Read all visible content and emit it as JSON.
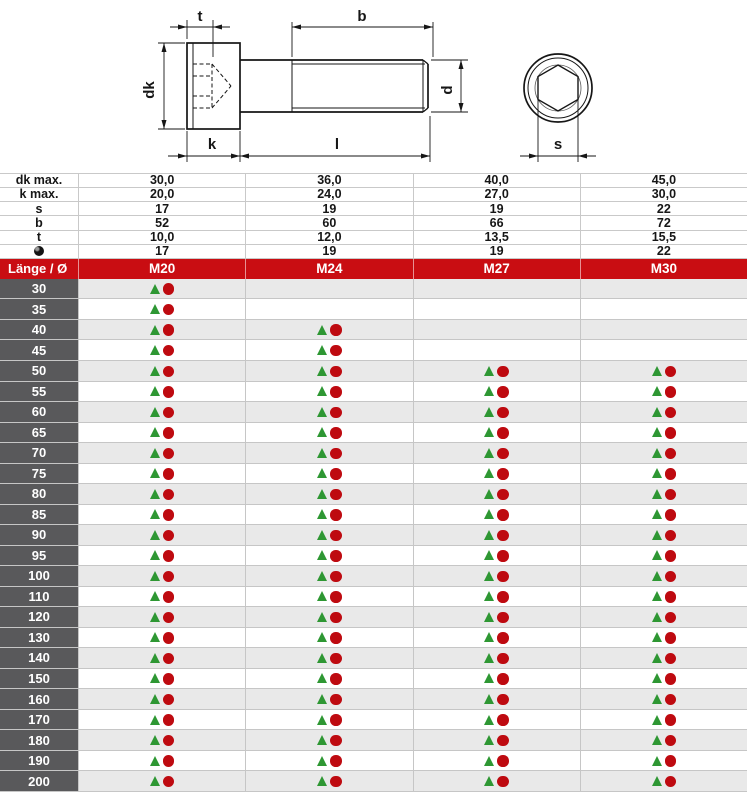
{
  "drawing": {
    "labels": {
      "t": "t",
      "b": "b",
      "dk": "dk",
      "k": "k",
      "l": "l",
      "d": "d",
      "s": "s"
    }
  },
  "spec_table": {
    "rows": [
      {
        "label": "dk max.",
        "values": [
          "30,0",
          "36,0",
          "40,0",
          "45,0"
        ]
      },
      {
        "label": "k max.",
        "values": [
          "20,0",
          "24,0",
          "27,0",
          "30,0"
        ]
      },
      {
        "label": "s",
        "values": [
          "17",
          "19",
          "19",
          "22"
        ]
      },
      {
        "label": "b",
        "values": [
          "52",
          "60",
          "66",
          "72"
        ]
      },
      {
        "label": "t",
        "values": [
          "10,0",
          "12,0",
          "13,5",
          "15,5"
        ]
      },
      {
        "label": "",
        "icon": "hex-key-size-icon",
        "values": [
          "17",
          "19",
          "19",
          "22"
        ]
      }
    ]
  },
  "main_table": {
    "header": {
      "label": "Länge / Ø",
      "columns": [
        "M20",
        "M24",
        "M27",
        "M30"
      ]
    },
    "rows": [
      {
        "length": "30",
        "available": [
          true,
          false,
          false,
          false
        ]
      },
      {
        "length": "35",
        "available": [
          true,
          false,
          false,
          false
        ]
      },
      {
        "length": "40",
        "available": [
          true,
          true,
          false,
          false
        ]
      },
      {
        "length": "45",
        "available": [
          true,
          true,
          false,
          false
        ]
      },
      {
        "length": "50",
        "available": [
          true,
          true,
          true,
          true
        ]
      },
      {
        "length": "55",
        "available": [
          true,
          true,
          true,
          true
        ]
      },
      {
        "length": "60",
        "available": [
          true,
          true,
          true,
          true
        ]
      },
      {
        "length": "65",
        "available": [
          true,
          true,
          true,
          true
        ]
      },
      {
        "length": "70",
        "available": [
          true,
          true,
          true,
          true
        ]
      },
      {
        "length": "75",
        "available": [
          true,
          true,
          true,
          true
        ]
      },
      {
        "length": "80",
        "available": [
          true,
          true,
          true,
          true
        ]
      },
      {
        "length": "85",
        "available": [
          true,
          true,
          true,
          true
        ]
      },
      {
        "length": "90",
        "available": [
          true,
          true,
          true,
          true
        ]
      },
      {
        "length": "95",
        "available": [
          true,
          true,
          true,
          true
        ]
      },
      {
        "length": "100",
        "available": [
          true,
          true,
          true,
          true
        ]
      },
      {
        "length": "110",
        "available": [
          true,
          true,
          true,
          true
        ]
      },
      {
        "length": "120",
        "available": [
          true,
          true,
          true,
          true
        ]
      },
      {
        "length": "130",
        "available": [
          true,
          true,
          true,
          true
        ]
      },
      {
        "length": "140",
        "available": [
          true,
          true,
          true,
          true
        ]
      },
      {
        "length": "150",
        "available": [
          true,
          true,
          true,
          true
        ]
      },
      {
        "length": "160",
        "available": [
          true,
          true,
          true,
          true
        ]
      },
      {
        "length": "170",
        "available": [
          true,
          true,
          true,
          true
        ]
      },
      {
        "length": "180",
        "available": [
          true,
          true,
          true,
          true
        ]
      },
      {
        "length": "190",
        "available": [
          true,
          true,
          true,
          true
        ]
      },
      {
        "length": "200",
        "available": [
          true,
          true,
          true,
          true
        ]
      }
    ]
  },
  "colors": {
    "header_red": "#c90d12",
    "length_column_gray": "#59595b",
    "alt_row_gray": "#e9e9e9",
    "grid_line": "#c6c6c6",
    "marker_triangle_green": "#2e9733",
    "marker_circle_red": "#be0a10"
  }
}
